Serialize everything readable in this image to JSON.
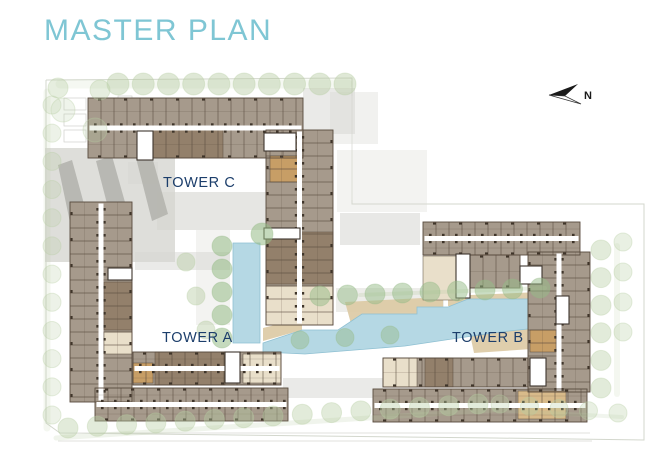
{
  "page": {
    "title": "MASTER PLAN"
  },
  "compass": {
    "label": "N"
  },
  "towers": [
    {
      "id": "tower-a",
      "label": "TOWER A"
    },
    {
      "id": "tower-b",
      "label": "TOWER B"
    },
    {
      "id": "tower-c",
      "label": "TOWER C"
    }
  ],
  "colors": {
    "title": "#7fc6d4",
    "label": "#1c3e6b",
    "building": "#a69a8c",
    "unitLine": "#584a3d",
    "tick": "#3f352a",
    "dark": "#93806b",
    "tan": "#c79e66",
    "tanlight": "#d8ba8a",
    "cream": "#e9dfca",
    "pool": "#b5d8e4",
    "poolEdge": "#8fc0d2",
    "deck": "#dbc9a3",
    "tree": "#b7cda3",
    "treeDark": "#96bb87",
    "gray": "#d6d6d1",
    "grayDark": "#b2b2ab",
    "line": "#c8cdc0"
  },
  "plan": {
    "boundary": "46,80 352,78 352,204 644,204 644,440 494,438 60,433 46,423 46,80",
    "roadLines": [
      {
        "x1": 60,
        "y1": 433,
        "x2": 590,
        "y2": 433
      },
      {
        "x1": 58,
        "y1": 441,
        "x2": 592,
        "y2": 441
      },
      {
        "x1": 352,
        "y1": 96,
        "x2": 352,
        "y2": 200
      }
    ],
    "smallRects": [
      {
        "x": 64,
        "y": 98,
        "w": 22,
        "h": 12
      },
      {
        "x": 64,
        "y": 114,
        "w": 22,
        "h": 12
      },
      {
        "x": 64,
        "y": 130,
        "w": 22,
        "h": 12
      },
      {
        "x": 118,
        "y": 96,
        "w": 14,
        "h": 10
      }
    ],
    "strips": [
      {
        "x1": 60,
        "y1": 84,
        "x2": 348,
        "y2": 84,
        "w": 9,
        "o": 0.13
      },
      {
        "x1": 47,
        "y1": 92,
        "x2": 47,
        "y2": 428,
        "w": 7,
        "o": 0.15
      },
      {
        "x1": 56,
        "y1": 438,
        "x2": 494,
        "y2": 410,
        "w": 5,
        "o": 0.2
      },
      {
        "x1": 494,
        "y1": 410,
        "x2": 622,
        "y2": 417,
        "w": 4,
        "o": 0.18
      },
      {
        "x1": 617,
        "y1": 246,
        "x2": 617,
        "y2": 394,
        "w": 6,
        "o": 0.15
      },
      {
        "x1": 360,
        "y1": 295,
        "x2": 545,
        "y2": 288,
        "w": 4,
        "o": 0.25
      }
    ],
    "grays": [
      {
        "x": 45,
        "y": 148,
        "w": 130,
        "h": 114,
        "o": 0.8
      },
      {
        "x": 157,
        "y": 192,
        "w": 112,
        "h": 38,
        "o": 0.6
      },
      {
        "x": 135,
        "y": 252,
        "w": 95,
        "h": 18,
        "o": 0.5
      },
      {
        "x": 196,
        "y": 230,
        "w": 34,
        "h": 95,
        "o": 0.3
      },
      {
        "x": 303,
        "y": 88,
        "w": 52,
        "h": 46,
        "o": 0.5
      },
      {
        "x": 330,
        "y": 92,
        "w": 48,
        "h": 52,
        "o": 0.35
      },
      {
        "x": 337,
        "y": 150,
        "w": 90,
        "h": 62,
        "o": 0.3
      },
      {
        "x": 340,
        "y": 213,
        "w": 80,
        "h": 32,
        "o": 0.55
      },
      {
        "x": 336,
        "y": 288,
        "w": 108,
        "h": 24,
        "o": 0.45
      },
      {
        "x": 283,
        "y": 378,
        "w": 100,
        "h": 20,
        "o": 0.5
      },
      {
        "x": 128,
        "y": 162,
        "w": 30,
        "h": 22,
        "o": 0.5
      }
    ],
    "chevrons": [
      "58,165 72,160 90,226 72,232",
      "96,161 112,156 130,220 113,227",
      "136,158 151,153 168,214 152,221"
    ],
    "decks": [
      "345,302 443,297 443,313 353,331",
      "448,296 541,292 545,306 448,306",
      "470,334 561,326 561,347 474,353",
      "263,328 302,318 302,330 263,341"
    ],
    "pools": [
      "233,243 260,243 260,343 233,343",
      "263,343 302,330 338,330 362,314 417,314 417,307 448,307 468,299 537,299 546,308 546,327 500,332 452,339 405,346 355,350 305,354 263,352"
    ],
    "wings": [
      {
        "x": 88,
        "y": 98,
        "w": 215,
        "h": 60,
        "o": "h"
      },
      {
        "x": 266,
        "y": 130,
        "w": 67,
        "h": 195,
        "o": "v"
      },
      {
        "x": 70,
        "y": 202,
        "w": 62,
        "h": 200,
        "o": "v"
      },
      {
        "x": 133,
        "y": 352,
        "w": 148,
        "h": 33,
        "o": "h"
      },
      {
        "x": 95,
        "y": 388,
        "w": 193,
        "h": 33,
        "o": "h"
      },
      {
        "x": 423,
        "y": 222,
        "w": 157,
        "h": 33,
        "o": "h"
      },
      {
        "x": 528,
        "y": 252,
        "w": 62,
        "h": 140,
        "o": "v"
      },
      {
        "x": 373,
        "y": 389,
        "w": 214,
        "h": 33,
        "o": "h"
      },
      {
        "x": 383,
        "y": 358,
        "w": 145,
        "h": 29,
        "o": "h1"
      },
      {
        "x": 470,
        "y": 255,
        "w": 50,
        "h": 33,
        "o": "h1"
      }
    ],
    "accents": [
      {
        "x": 153,
        "y": 130,
        "w": 70,
        "h": 28,
        "c": "dark"
      },
      {
        "x": 270,
        "y": 156,
        "w": 28,
        "h": 26,
        "c": "tan"
      },
      {
        "x": 266,
        "y": 232,
        "w": 67,
        "h": 52,
        "c": "dark"
      },
      {
        "x": 266,
        "y": 286,
        "w": 67,
        "h": 39,
        "c": "cream"
      },
      {
        "x": 104,
        "y": 282,
        "w": 28,
        "h": 48,
        "c": "dark"
      },
      {
        "x": 104,
        "y": 332,
        "w": 28,
        "h": 22,
        "c": "cream"
      },
      {
        "x": 155,
        "y": 352,
        "w": 70,
        "h": 33,
        "c": "dark"
      },
      {
        "x": 243,
        "y": 354,
        "w": 38,
        "h": 29,
        "c": "cream"
      },
      {
        "x": 133,
        "y": 363,
        "w": 20,
        "h": 20,
        "c": "tan"
      },
      {
        "x": 423,
        "y": 256,
        "w": 36,
        "h": 44,
        "c": "cream"
      },
      {
        "x": 530,
        "y": 330,
        "w": 26,
        "h": 22,
        "c": "tan"
      },
      {
        "x": 518,
        "y": 391,
        "w": 48,
        "h": 28,
        "c": "tanlight"
      },
      {
        "x": 383,
        "y": 358,
        "w": 34,
        "h": 29,
        "c": "cream"
      },
      {
        "x": 425,
        "y": 358,
        "w": 28,
        "h": 29,
        "c": "dark"
      }
    ],
    "stairs": [
      {
        "x": 137,
        "y": 131,
        "w": 16,
        "h": 29
      },
      {
        "x": 264,
        "y": 133,
        "w": 32,
        "h": 18
      },
      {
        "x": 264,
        "y": 228,
        "w": 36,
        "h": 11
      },
      {
        "x": 225,
        "y": 352,
        "w": 15,
        "h": 31
      },
      {
        "x": 108,
        "y": 268,
        "w": 24,
        "h": 12
      },
      {
        "x": 456,
        "y": 254,
        "w": 14,
        "h": 44
      },
      {
        "x": 520,
        "y": 266,
        "w": 22,
        "h": 18
      },
      {
        "x": 530,
        "y": 358,
        "w": 16,
        "h": 28
      },
      {
        "x": 556,
        "y": 296,
        "w": 13,
        "h": 28
      }
    ],
    "treeRows": [
      {
        "x1": 118,
        "y1": 84,
        "x2": 345,
        "y2": 84,
        "n": 10,
        "r": 11,
        "o": 0.45
      },
      {
        "x1": 58,
        "y1": 88,
        "x2": 100,
        "y2": 90,
        "n": 2,
        "r": 10,
        "o": 0.35
      },
      {
        "x1": 52,
        "y1": 105,
        "x2": 52,
        "y2": 415,
        "n": 12,
        "r": 9,
        "o": 0.25
      },
      {
        "x1": 68,
        "y1": 428,
        "x2": 478,
        "y2": 404,
        "n": 15,
        "r": 10,
        "o": 0.4
      },
      {
        "x1": 500,
        "y1": 404,
        "x2": 618,
        "y2": 413,
        "n": 5,
        "r": 9,
        "o": 0.3
      },
      {
        "x1": 601,
        "y1": 250,
        "x2": 601,
        "y2": 388,
        "n": 6,
        "r": 10,
        "o": 0.4
      },
      {
        "x1": 623,
        "y1": 242,
        "x2": 623,
        "y2": 332,
        "n": 4,
        "r": 9,
        "o": 0.3
      },
      {
        "x1": 222,
        "y1": 246,
        "x2": 222,
        "y2": 338,
        "n": 5,
        "r": 10,
        "d": 1,
        "o": 0.55
      },
      {
        "x1": 320,
        "y1": 296,
        "x2": 540,
        "y2": 288,
        "n": 9,
        "r": 10,
        "d": 1,
        "o": 0.5
      },
      {
        "x1": 300,
        "y1": 340,
        "x2": 390,
        "y2": 335,
        "n": 3,
        "r": 9,
        "d": 1,
        "o": 0.45
      },
      {
        "x1": 186,
        "y1": 262,
        "x2": 206,
        "y2": 330,
        "n": 3,
        "r": 9,
        "o": 0.45
      },
      {
        "x1": 262,
        "y1": 234,
        "x2": 262,
        "y2": 234,
        "n": 1,
        "r": 11,
        "d": 1,
        "o": 0.55
      },
      {
        "x1": 63,
        "y1": 110,
        "x2": 95,
        "y2": 130,
        "n": 2,
        "r": 12,
        "o": 0.22
      }
    ]
  }
}
